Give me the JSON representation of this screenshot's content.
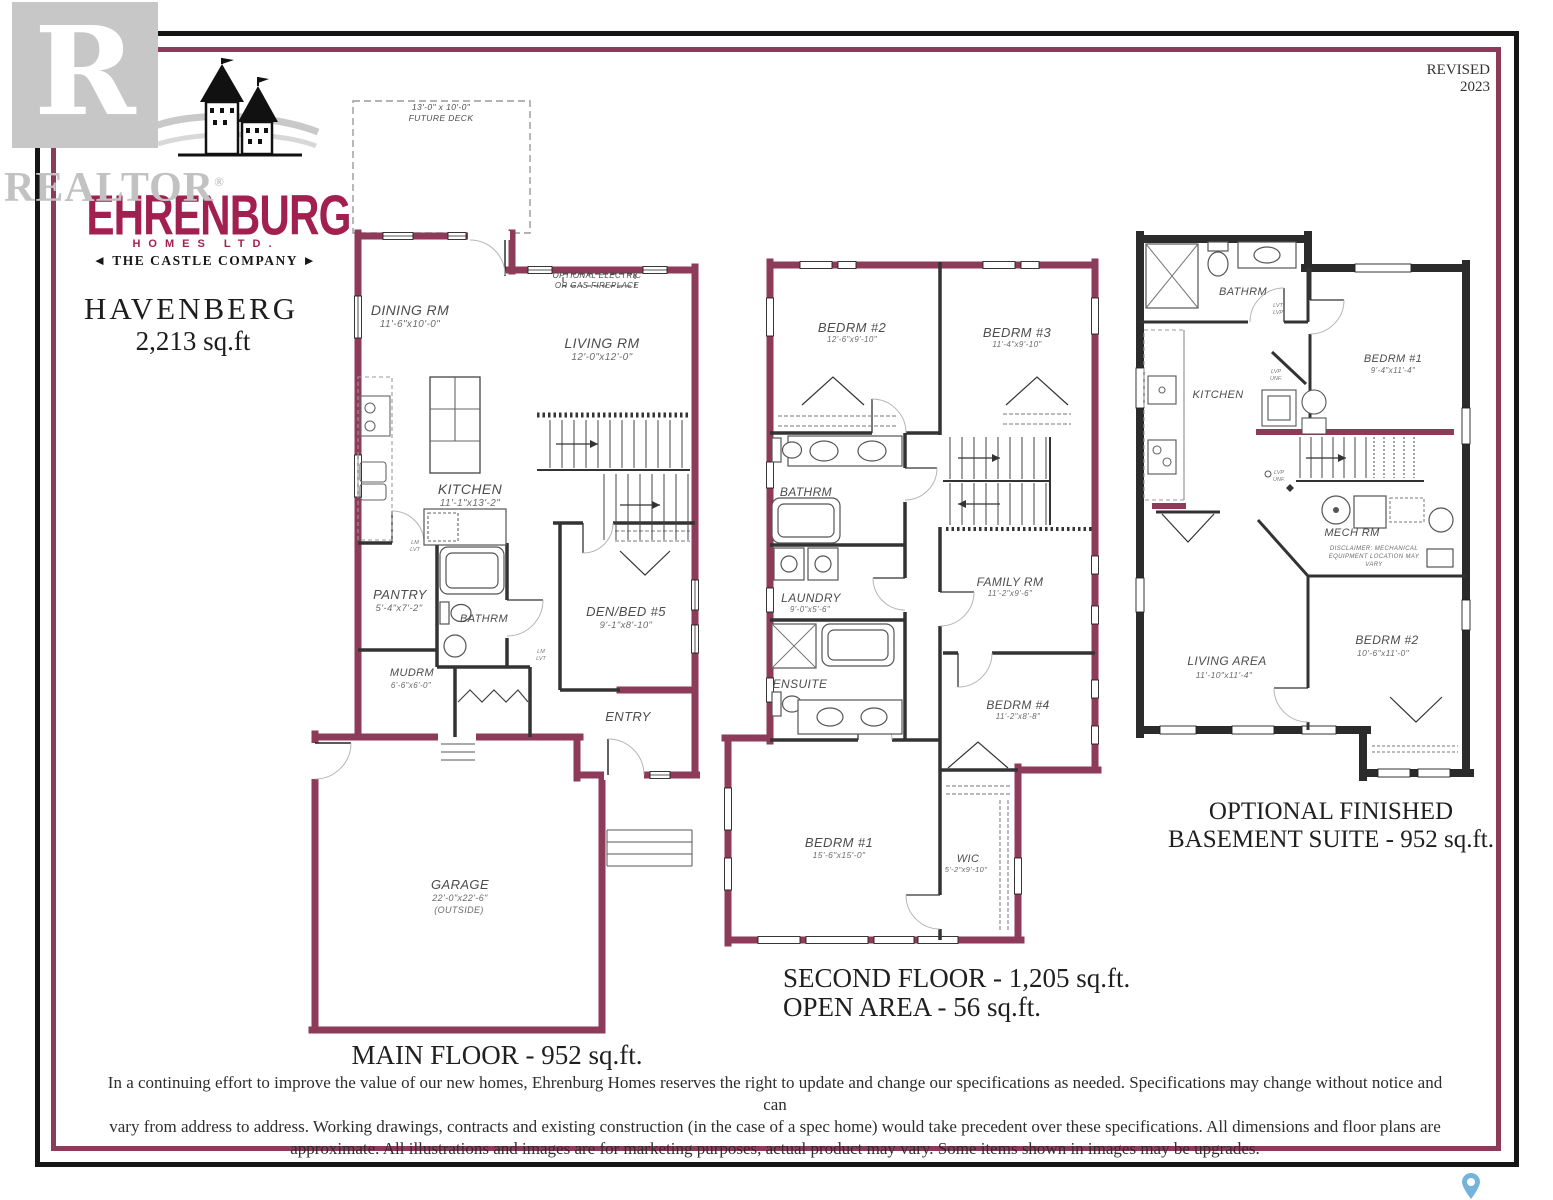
{
  "meta": {
    "revised": "REVISED 2023"
  },
  "watermark": {
    "text": "REALTOR",
    "reg": "®",
    "r_letter": "R"
  },
  "logo": {
    "brand": "EHRENBURG",
    "homes": "HOMES LTD.",
    "tagline": "◄ THE CASTLE COMPANY ►"
  },
  "title": {
    "model": "HAVENBERG",
    "area": "2,213 sq.ft"
  },
  "colors": {
    "wall_maroon": "#8e3a59",
    "brand_maroon": "#a22050",
    "frame_black": "#151515",
    "concrete": "#2b2b2b",
    "pin_blue": "#74b3db"
  },
  "plans": {
    "main": {
      "caption": "MAIN FLOOR - 952 sq.ft.",
      "deck": {
        "dims": "13'-0\" x 10'-0\"",
        "name": "FUTURE DECK"
      },
      "fireplace_note_1": "OPTIONAL ELECTRIC",
      "fireplace_note_2": "OR GAS FIREPLACE",
      "rooms": {
        "dining": {
          "name": "DINING RM",
          "dims": "11'-6\"x10'-0\""
        },
        "living": {
          "name": "LIVING RM",
          "dims": "12'-0\"x12'-0\""
        },
        "kitchen": {
          "name": "KITCHEN",
          "dims": "11'-1\"x13'-2\""
        },
        "pantry": {
          "name": "PANTRY",
          "dims": "5'-4\"x7'-2\""
        },
        "bath": {
          "name": "BATHRM"
        },
        "den": {
          "name": "DEN/BED #5",
          "dims": "9'-1\"x8'-10\""
        },
        "mud": {
          "name": "MUDRM",
          "dims": "6'-6\"x6'-0\""
        },
        "entry": {
          "name": "ENTRY"
        },
        "garage": {
          "name": "GARAGE",
          "dims": "22'-0\"x22'-6\"",
          "note": "(OUTSIDE)"
        }
      },
      "tags": {
        "t1a": "LM",
        "t1b": "LVT",
        "t2a": "LM",
        "t2b": "LVT"
      }
    },
    "second": {
      "caption_1": "SECOND FLOOR - 1,205 sq.ft.",
      "caption_2": "OPEN AREA - 56 sq.ft.",
      "rooms": {
        "bed2": {
          "name": "BEDRM #2",
          "dims": "12'-6\"x9'-10\""
        },
        "bed3": {
          "name": "BEDRM #3",
          "dims": "11'-4\"x9'-10\""
        },
        "bath": {
          "name": "BATHRM"
        },
        "laundry": {
          "name": "LAUNDRY",
          "dims": "9'-0\"x5'-6\""
        },
        "family": {
          "name": "FAMILY RM",
          "dims": "11'-2\"x9'-6\""
        },
        "ensuite": {
          "name": "ENSUITE"
        },
        "bed4": {
          "name": "BEDRM #4",
          "dims": "11'-2\"x8'-8\""
        },
        "bed1": {
          "name": "BEDRM #1",
          "dims": "15'-6\"x15'-0\""
        },
        "wic": {
          "name": "WIC",
          "dims": "5'-2\"x9'-10\""
        }
      }
    },
    "basement": {
      "caption_1": "OPTIONAL FINISHED",
      "caption_2": "BASEMENT SUITE - 952 sq.ft.",
      "rooms": {
        "bath": {
          "name": "BATHRM"
        },
        "kitchen": {
          "name": "KITCHEN"
        },
        "bed1": {
          "name": "BEDRM #1",
          "dims": "9'-4\"x11'-4\""
        },
        "mech": {
          "name": "MECH RM",
          "disclaimer_1": "DISCLAIMER: MECHANICAL",
          "disclaimer_2": "EQUIPMENT LOCATION MAY",
          "disclaimer_3": "VARY"
        },
        "living": {
          "name": "LIVING AREA",
          "dims": "11'-10\"x11'-4\""
        },
        "bed2": {
          "name": "BEDRM #2",
          "dims": "10'-6\"x11'-0\""
        }
      },
      "tags": {
        "t1a": "LVT",
        "t1b": "LVP",
        "t2a": "LVP",
        "t2b": "UNF.",
        "t3a": "LVP",
        "t3b": "UNF."
      }
    }
  },
  "footer": {
    "line1": "In a continuing effort to improve the value of our new homes, Ehrenburg Homes reserves the right to update and change our specifications as needed. Specifications may change without notice and can",
    "line2": "vary from address to address. Working drawings, contracts and existing construction (in the case of a spec home) would take precedent over these specifications. All dimensions and floor plans are",
    "line3": "approximate. All illustrations and images are for marketing purposes, actual product may vary. Some items shown in images may be upgrades."
  }
}
